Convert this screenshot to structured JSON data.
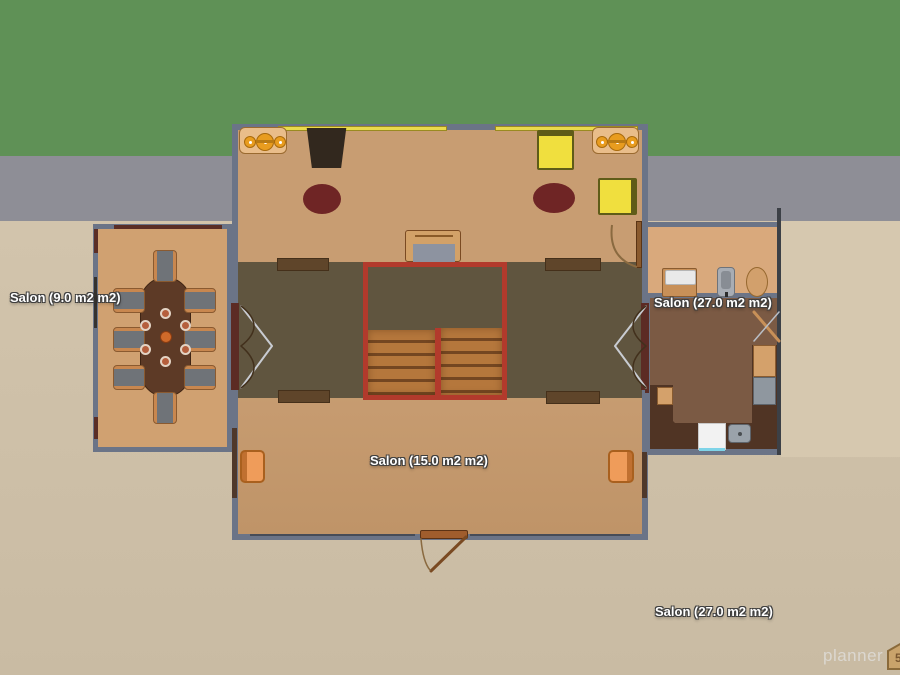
{
  "app": {
    "name": "floor-plan-view"
  },
  "rooms": [
    {
      "id": "dining",
      "label": "Salon (9.0 m2 m2)"
    },
    {
      "id": "bath",
      "label": "Salon (27.0 m2 m2)"
    },
    {
      "id": "living",
      "label": "Salon (15.0 m2 m2)"
    },
    {
      "id": "ground",
      "label": "Salon (27.0 m2 m2)"
    }
  ],
  "watermark": {
    "brand": "planner",
    "badge": "5d"
  },
  "palette": {
    "grass": "#5f9156",
    "path_gray": "#8e8e96",
    "ground": "#cbbda5",
    "wall": "#6b7487",
    "floor_main": "#c89d72",
    "floor_zone_dark": "#60553f",
    "floor_dining": "#d0a171",
    "floor_bath": "#d9a97c",
    "floor_kitchen": "#7b5a44",
    "stairs_border_red": "#b23a2c",
    "stair_step": "#b5773c",
    "window_yellow": "#ead94e",
    "door_red": "#5c2b24",
    "accent_yellow_chair": "#f0df3e",
    "accent_orange_chair": "#ef9c5a",
    "rug_maroon": "#6f2525"
  }
}
